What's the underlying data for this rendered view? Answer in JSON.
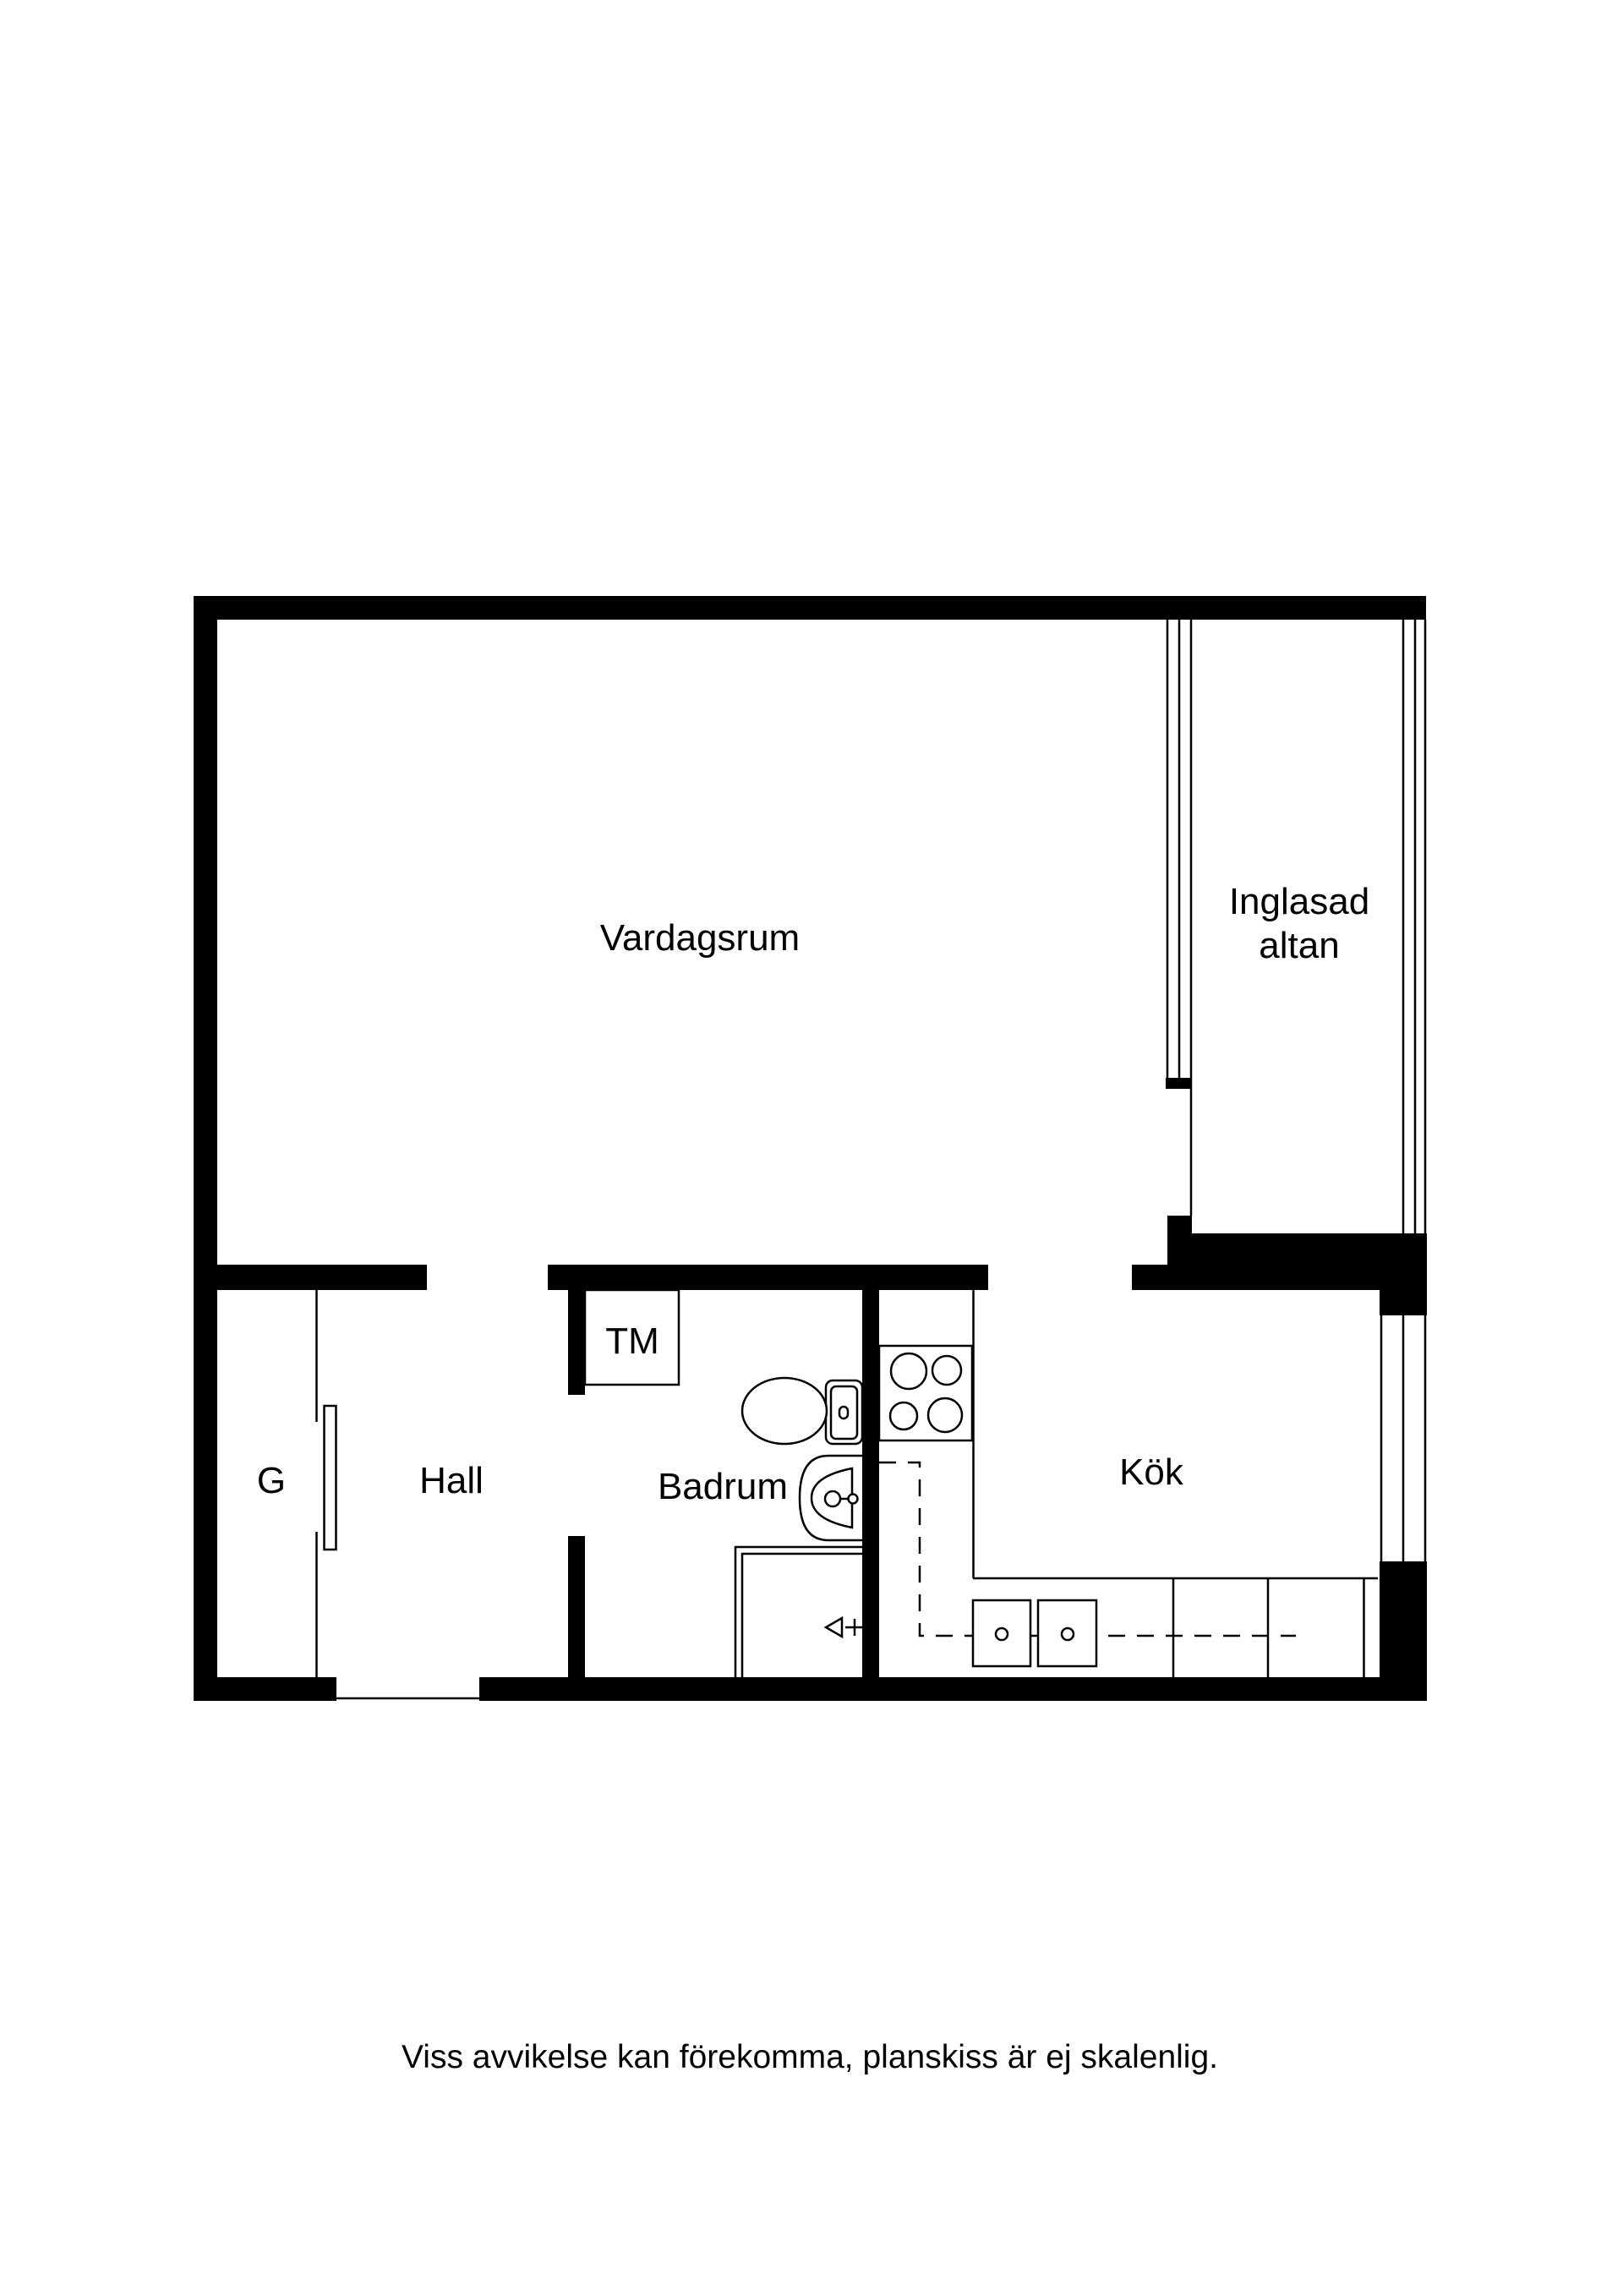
{
  "floorplan": {
    "rooms": {
      "vardagsrum": {
        "label": "Vardagssrum_PLACEHOLDER"
      },
      "inglasad_altan": {
        "line1": "Inglasad",
        "line2": "altan"
      },
      "garderob": {
        "label": "G"
      },
      "hall": {
        "label": "Hall"
      },
      "tvattmaskin": {
        "label": "TM"
      },
      "badrum": {
        "label": "Badrum"
      },
      "kok": {
        "label": "Kök"
      }
    },
    "disclaimer": "Viss avvikelse kan förekomma, planskiss är ej skalenlig.",
    "colors": {
      "wall": "#000000",
      "line": "#000000",
      "text": "#000000",
      "background": "#ffffff"
    }
  }
}
